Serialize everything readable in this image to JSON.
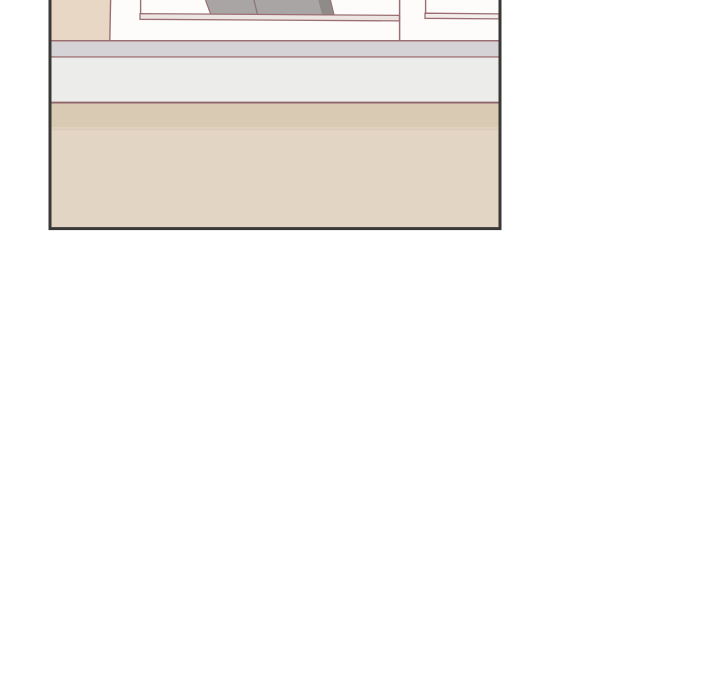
{
  "page": {
    "background": "#ffffff",
    "content_type": "comic-panel-illustration",
    "visible_text": []
  },
  "colors": {
    "panel_bg": "#fdfcfb",
    "panel_border": "#3a3837",
    "outline": "#9b6f72",
    "outline_dark": "#8f676b",
    "wall_beige": "#e8d7c4",
    "object_gray": "#a8a5a4",
    "object_gray_dark": "#8e8b89",
    "object_divider": "#8a7274",
    "desk_edge_fill": "#ece5e2",
    "desk_edge_fill_right": "#f3eeec"
  },
  "panel": {
    "bands": [
      {
        "name": "room-white",
        "color": "#fdfcfb"
      },
      {
        "name": "counter-gray",
        "color": "#d6d3d7"
      },
      {
        "name": "counter-face",
        "color": "#ecedeb"
      },
      {
        "name": "floor-tan-dark",
        "color": "#d8cab3"
      },
      {
        "name": "floor-tan-blend",
        "color": "#ddcfbb"
      },
      {
        "name": "floor-tan-light",
        "color": "#e3d5c3"
      }
    ]
  }
}
